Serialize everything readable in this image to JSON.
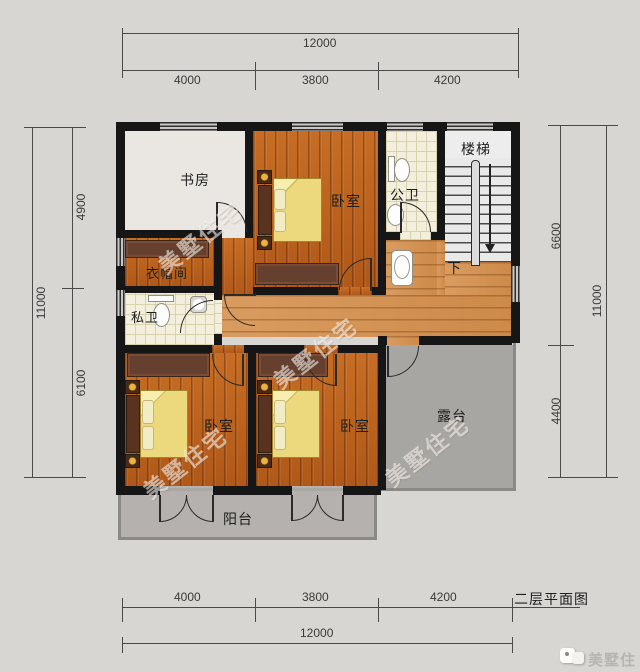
{
  "drawing_title": "二层平面图",
  "watermark_text": "美墅住宅",
  "logo_text": "美墅住宅",
  "rooms": {
    "study": "书房",
    "bedroom_top": "卧室",
    "public_bath": "公卫",
    "stairs": "楼梯",
    "stairs_down": "下",
    "cloakroom": "衣帽间",
    "private_bath": "私卫",
    "bedroom_left": "卧室",
    "bedroom_mid": "卧室",
    "terrace": "露台",
    "balcony": "阳台"
  },
  "dimensions": {
    "top": {
      "total": "12000",
      "segments": [
        "4000",
        "3800",
        "4200"
      ]
    },
    "bottom": {
      "total": "12000",
      "segments": [
        "4000",
        "3800",
        "4200"
      ]
    },
    "left": {
      "total": "11000",
      "segments": [
        "4900",
        "6100"
      ]
    },
    "right": {
      "total": "11000",
      "segments": [
        "6600",
        "4400"
      ]
    }
  },
  "colors": {
    "wall": "#161616",
    "bedroom_wood": "#bc6120",
    "corridor_wood": "#d4975b",
    "tile": "#f3efdc",
    "terrace": "#a8a6a3",
    "balcony": "#b4b1ae",
    "blanket": "#ecd97e",
    "background": "#d8d6d3"
  }
}
